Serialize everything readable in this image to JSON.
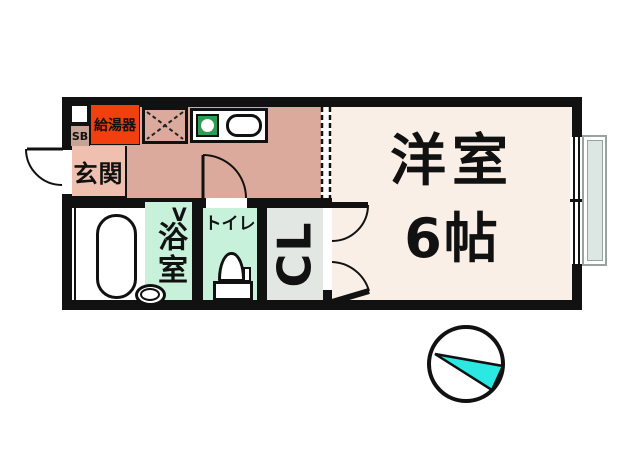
{
  "floorplan": {
    "labels": {
      "water_heater": "給湯器",
      "shoe_box": "SB",
      "entrance": "玄関",
      "bathroom": "浴室",
      "bathroom_door_mark": "V",
      "toilet": "トイレ",
      "closet": "CL",
      "main_room_name": "洋室",
      "main_room_size": "6帖"
    },
    "compass": {
      "type": "north-arrow-in-circle",
      "arrow_points": "left"
    },
    "colors": {
      "wall": "#111111",
      "kitchen_floor": "#dcaa9c",
      "entrance_floor": "#efc0b0",
      "shoe_box_bg": "#c7a396",
      "water_heater_bg": "#f23f0f",
      "main_room_floor": "#faefe6",
      "wet_area_floor": "#c8f1dc",
      "closet_floor": "#e2e7e4",
      "burner_green": "#2f9c55",
      "window_glass": "#dce6e2",
      "compass_cyan": "#2be8e2"
    }
  }
}
